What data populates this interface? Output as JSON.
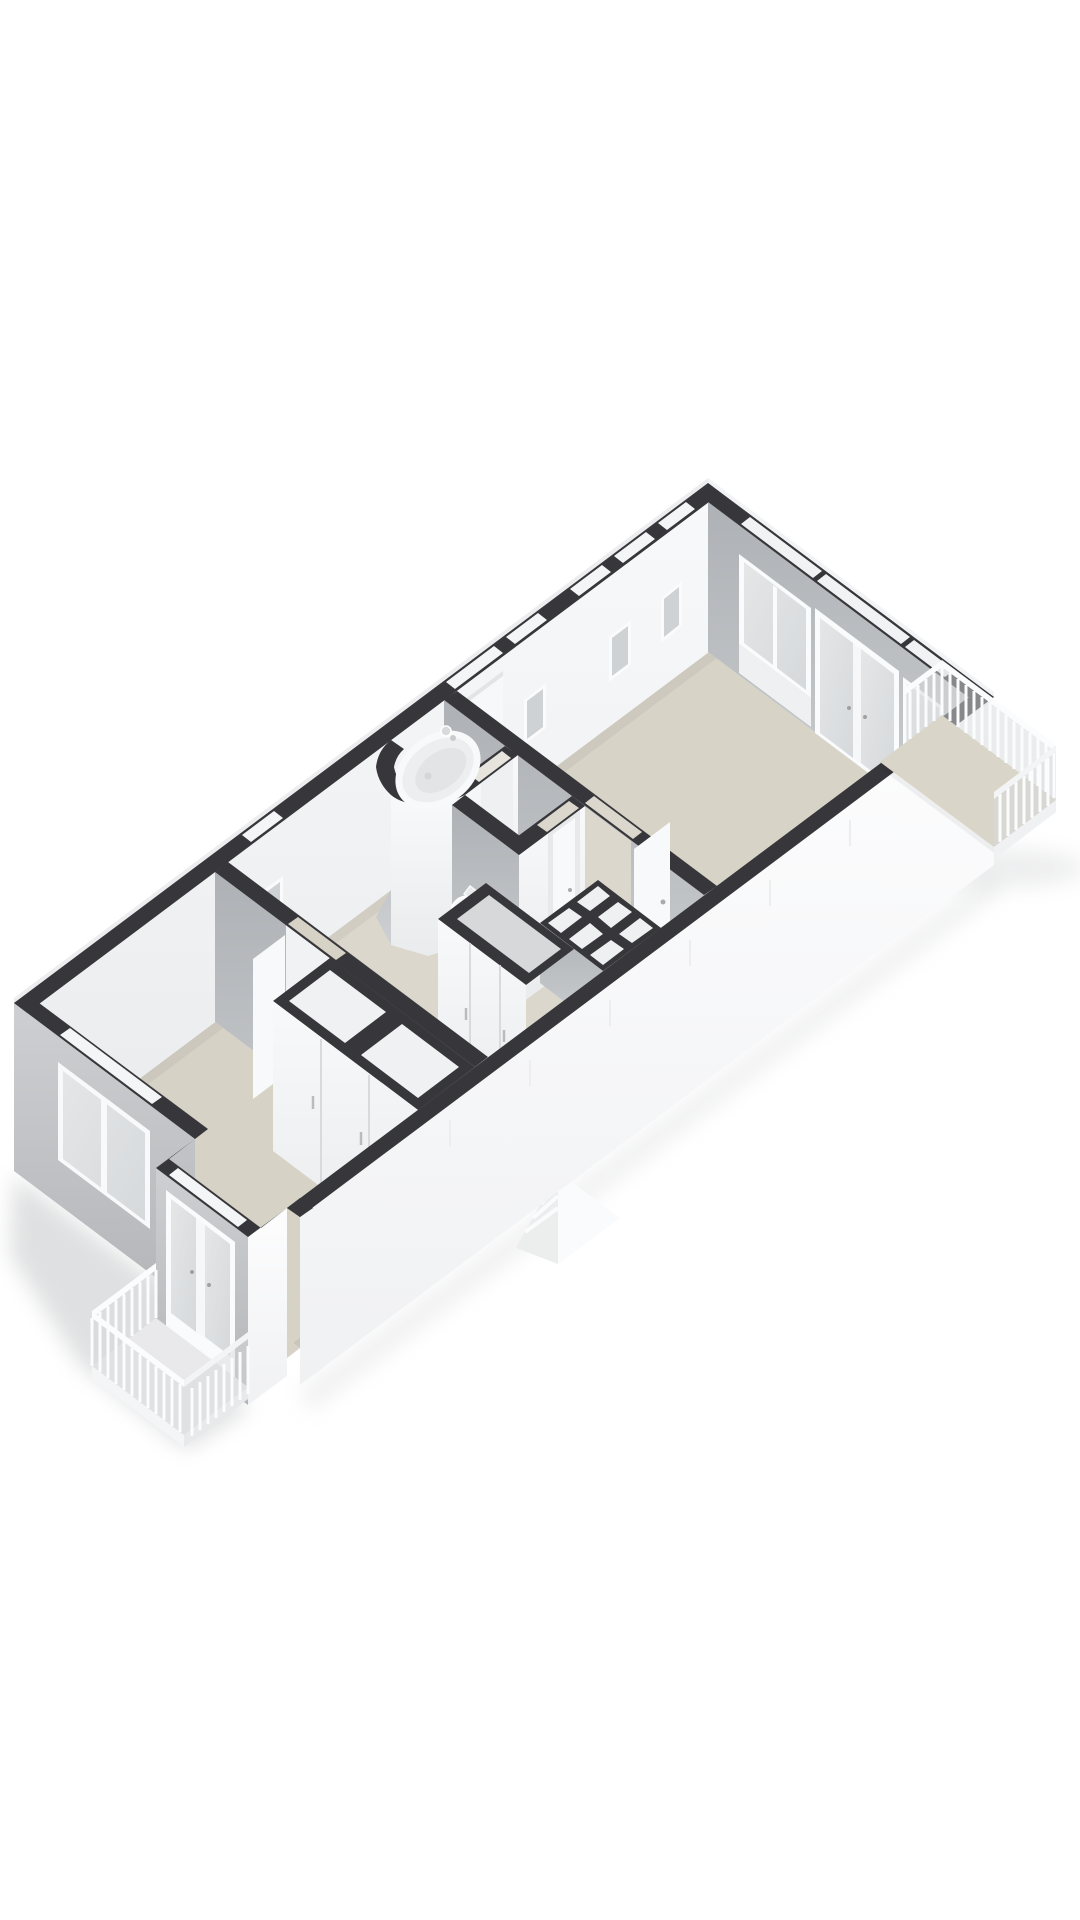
{
  "scene": {
    "label": "3D axonometric floor plan render",
    "background_color": "#ffffff"
  },
  "palette": {
    "wall_top": "#37373b",
    "wall_face_white": "#f6f7f8",
    "wall_face_gray": "#b5b8bb",
    "exterior_gray": "#c6c8cb",
    "exterior_white": "#f9fafb",
    "floor_living": "#d7d3c7",
    "floor_hall": "#dbd7cc",
    "floor_bedroom": "#d6d2c6",
    "floor_wc": "#e2e0d8",
    "floor_bath": "#e6e4dc",
    "floor_balcony_left": "#e9e9eb",
    "floor_balcony_right": "#d9d5c9",
    "cell_floor": "#eff0f1",
    "glass": "#e0e2e4",
    "frame_white": "#fafbfc",
    "railing_white": "#fbfcfd",
    "fixture_white": "#f4f5f6"
  },
  "building": {
    "rooms": [
      {
        "name": "living-room"
      },
      {
        "name": "hallway"
      },
      {
        "name": "bathroom"
      },
      {
        "name": "wc"
      },
      {
        "name": "bedroom"
      }
    ],
    "balconies": [
      {
        "name": "balcony-northeast",
        "railing": "white vertical slats"
      },
      {
        "name": "balcony-southwest",
        "railing": "white vertical slats"
      }
    ],
    "fixtures": [
      {
        "name": "bathtub"
      },
      {
        "name": "toilet"
      },
      {
        "name": "washbasin"
      }
    ],
    "storage": [
      {
        "name": "hall-closet"
      },
      {
        "name": "utility-compartments"
      },
      {
        "name": "bedroom-closet"
      }
    ],
    "openings": {
      "slot_windows_top_edge": 6,
      "small_square_windows": 4,
      "living_room_window_door_set": 1,
      "bedroom_window": 1,
      "balcony_french_doors": 2,
      "interior_doors": 4
    }
  }
}
